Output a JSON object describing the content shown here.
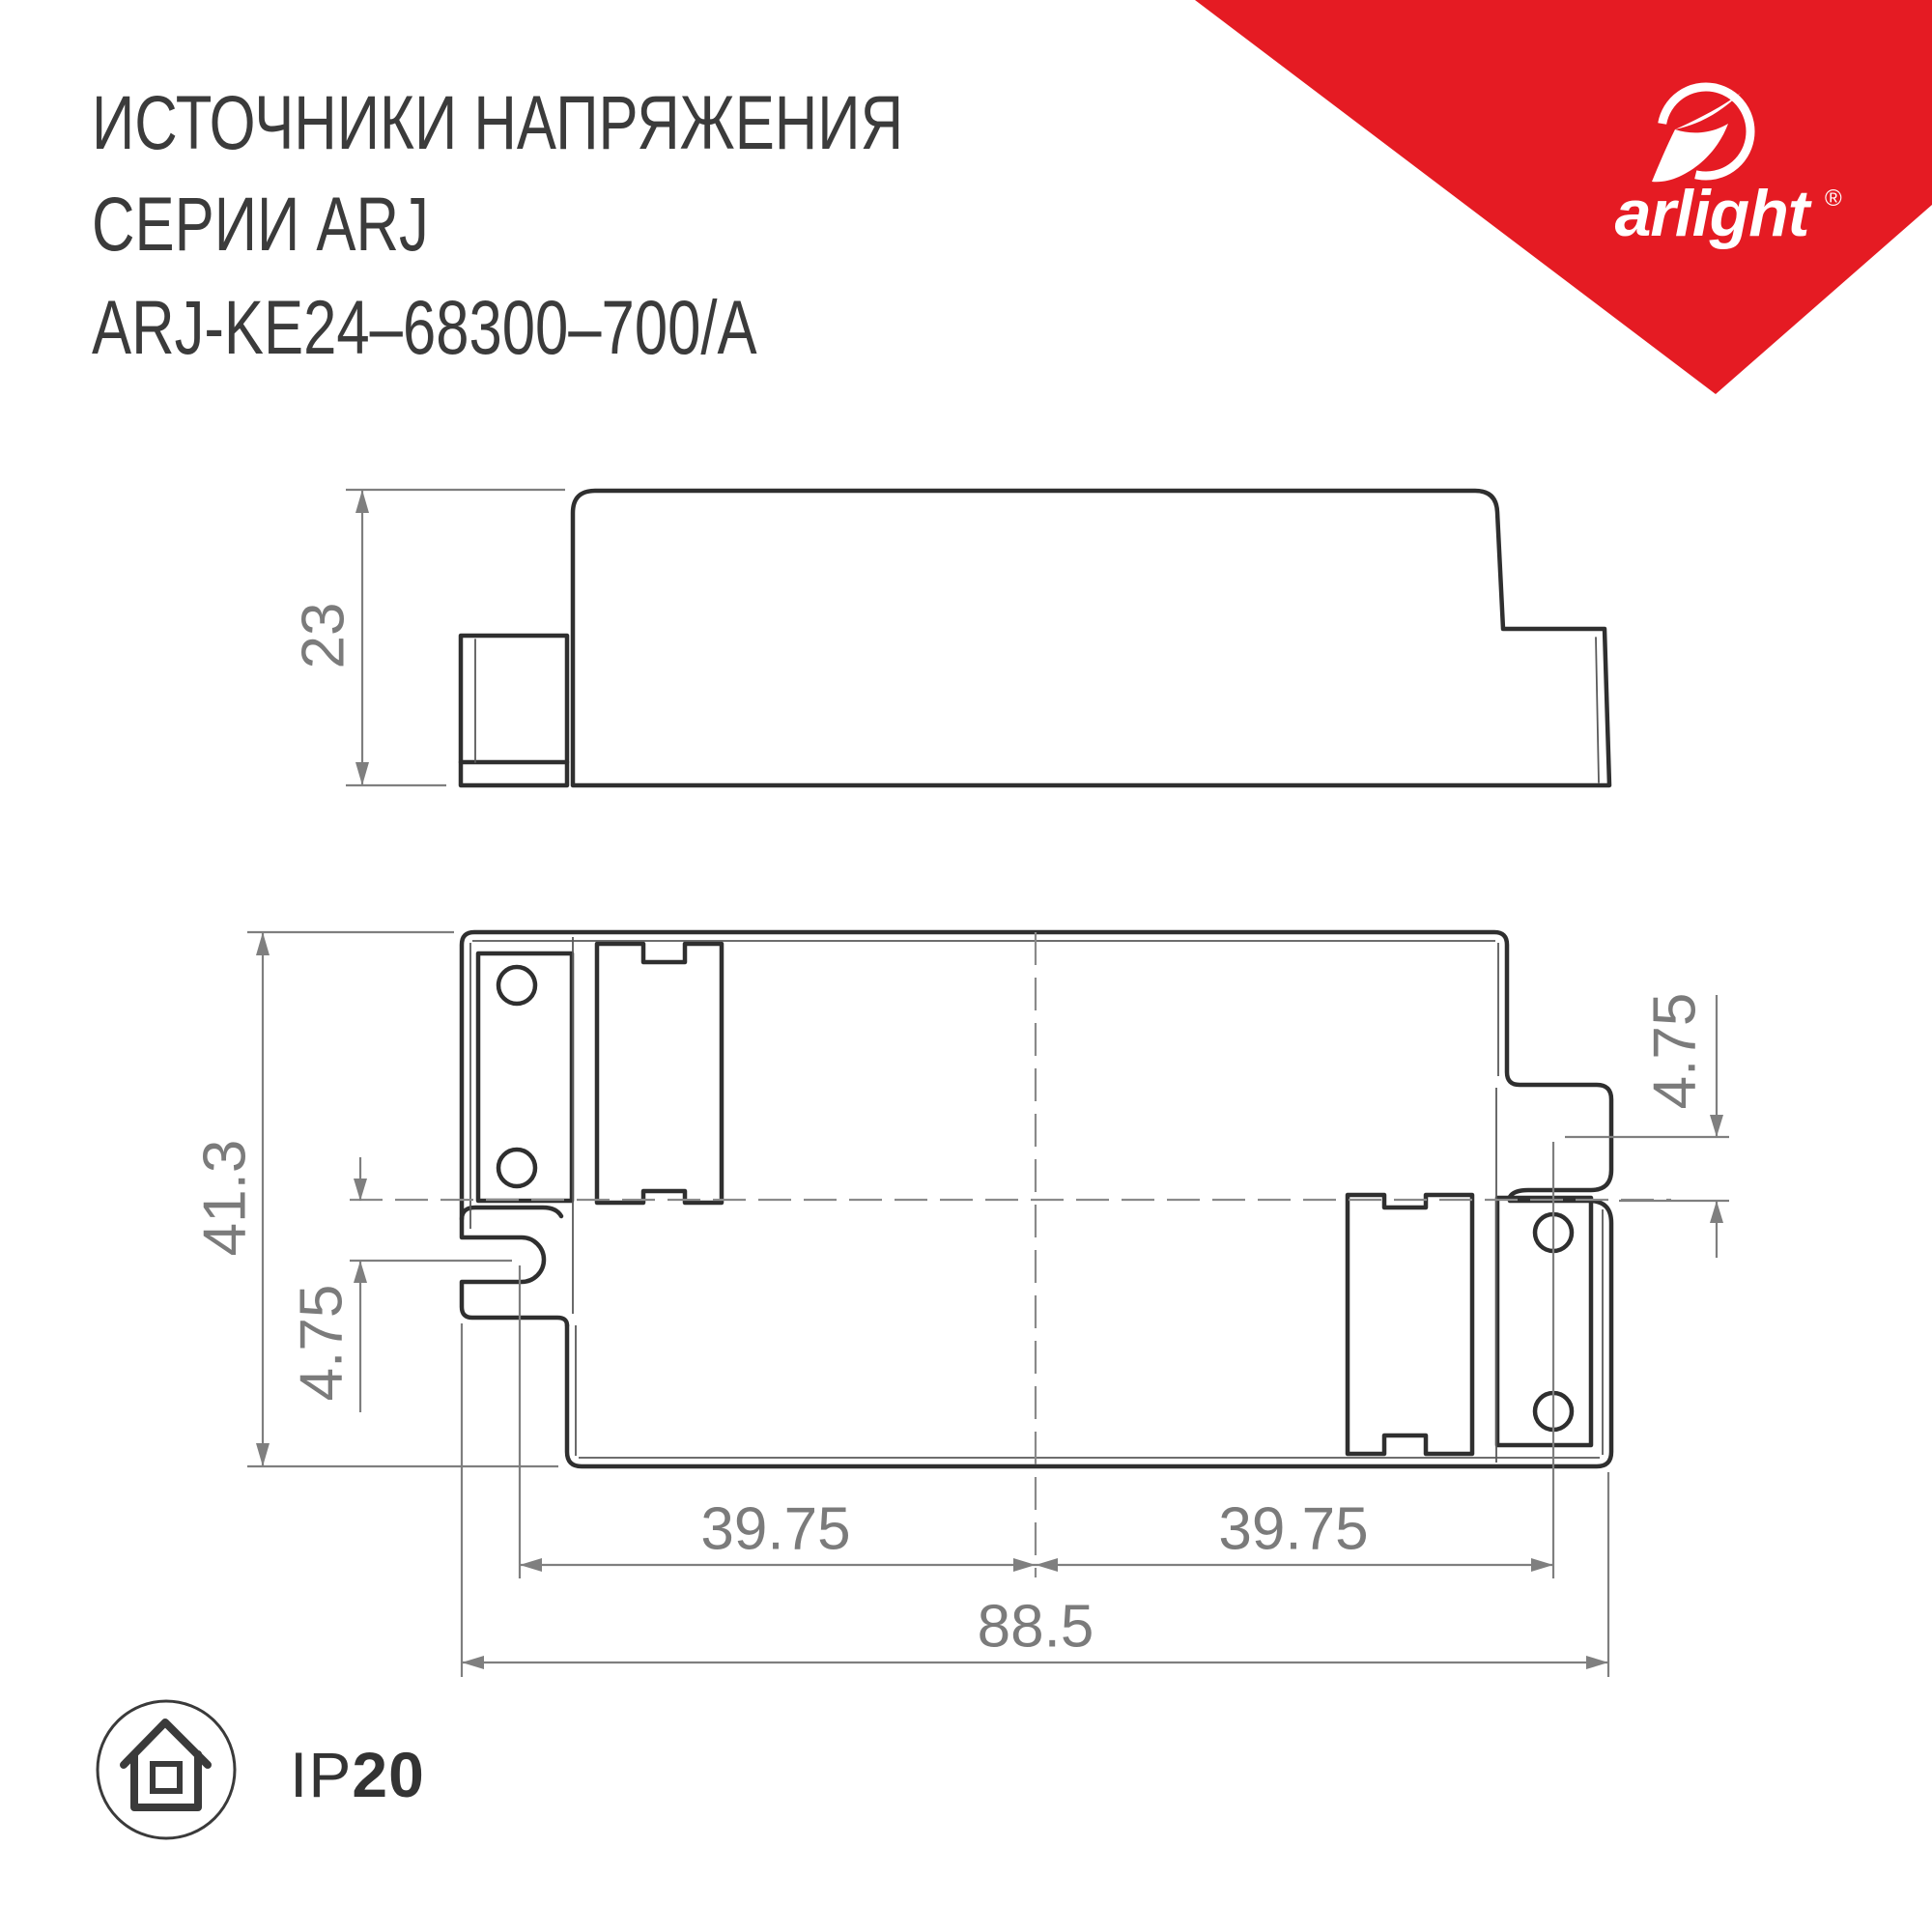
{
  "title": {
    "line1": "ИСТОЧНИКИ НАПРЯЖЕНИЯ",
    "line2": "СЕРИИ ARJ",
    "line3": "ARJ-KE24–68300–700/A"
  },
  "brand": {
    "wordmark": "arlight",
    "registered": "®",
    "accent_color": "#e51b23"
  },
  "drawing": {
    "units_note": "",
    "side_view": {
      "height": "23"
    },
    "top_view": {
      "height": "41.3",
      "ear_offset_left": "4.75",
      "ear_offset_right": "4.75",
      "hole_span_left": "39.75",
      "hole_span_right": "39.75",
      "overall_width": "88.5"
    },
    "line_color": "#2f2f2f",
    "dim_color": "#7b7b7b"
  },
  "footer": {
    "ip_prefix": "IP",
    "ip_value": "20"
  }
}
